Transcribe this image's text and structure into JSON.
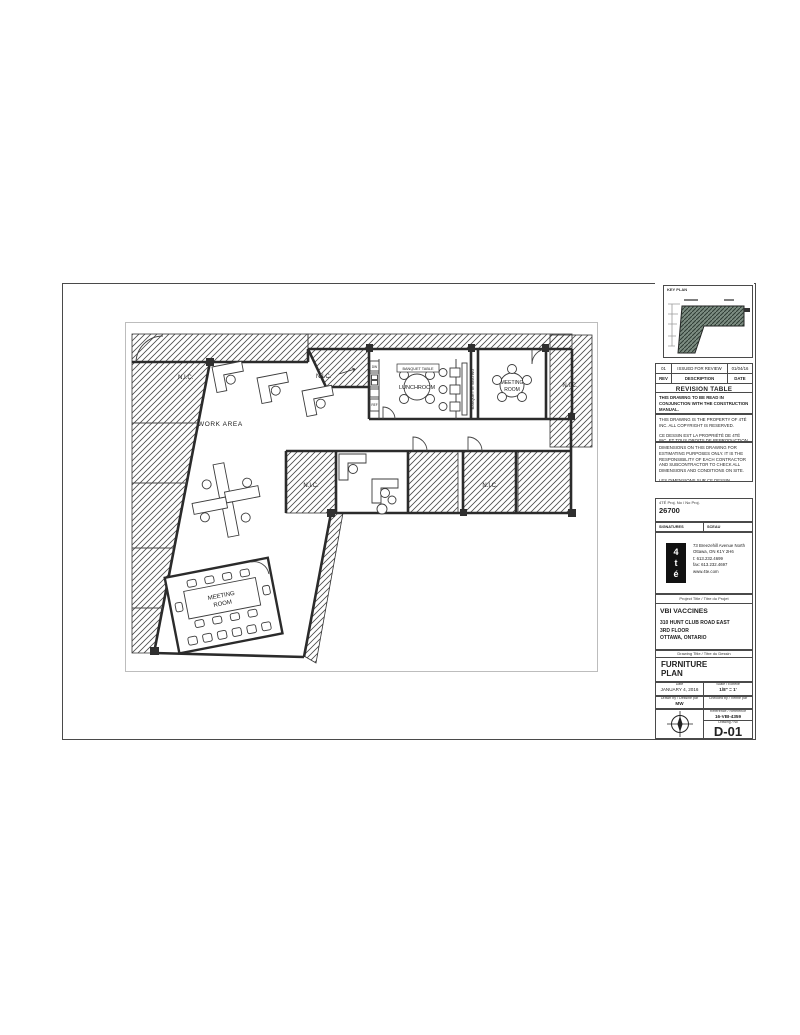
{
  "sheet": {
    "plan": {
      "labels": {
        "work_area": "WORK AREA",
        "lunchroom": "LUNCHROOM",
        "meeting_line1": "MEETING",
        "meeting_line2": "ROOM",
        "nic": "N.I.C.",
        "banquet_table": "BANQUET TABLE",
        "banquette_seating": "BANQUETTE SEATING",
        "dw": "DW",
        "ref": "REF"
      }
    },
    "titleblock": {
      "keyplan_label": "KEY PLAN",
      "revision_table": {
        "title": "REVISION TABLE",
        "header": [
          "REV",
          "DESCRIPTION",
          "DATE"
        ],
        "rows": [
          [
            "01",
            "ISSUED FOR REVIEW",
            "01/04/16"
          ]
        ]
      },
      "notes": [
        "THIS DRAWING TO BE READ IN CONJUNCTION WITH THE CONSTRUCTION MANUAL.",
        "THIS DRAWING IS THE PROPERTY OF 4TÉ INC. ALL COPYRIGHT IS RESERVED.",
        "CE DESSIN EST LA PROPRIÉTÉ DE 4TÉ INC. ET TOUS DROITS DE REPRODUCTION SONT RÉSERVÉS.",
        "DIMENSIONS ON THIS DRAWING FOR ESTIMATING PURPOSES ONLY. IT IS THE RESPONSIBILITY OF EACH CONTRACTOR AND SUBCONTRACTOR TO CHECK ALL DIMENSIONS AND CONDITIONS ON SITE.",
        "LES DIMENSIONS SUR CE DESSIN SERVENT UNIQUEMENT POUR ÉTABLIR UN DEVIS. LES ENTREPRENEURS DEVRONT PRENDRE LEURS PROPRES MESURES SUR LES LIEUX ET EN ÊTRE RESPONSABLES."
      ],
      "project_no_label": "4TÉ Proj. No / No Proj.",
      "project_no": "26700",
      "signatures_label": "SIGNATURES",
      "seal_label": "SCEAU",
      "firm": {
        "logo_text": "4té",
        "address_line1": "73 Breezehill Avenue North",
        "address_line2": "Ottawa, ON K1Y 2H6",
        "phone": "t: 613.232.4699",
        "fax": "fax: 613.232.4697",
        "web": "www.4te.com"
      },
      "project_title_label": "Project Title / Titre du Projet",
      "project_name": "VBI VACCINES",
      "project_address": [
        "310 HUNT CLUB ROAD EAST",
        "3RD FLOOR",
        "OTTAWA, ONTARIO"
      ],
      "drawing_title_label": "Drawing Title / Titre du Dessin",
      "drawing_title_line1": "FURNITURE",
      "drawing_title_line2": "PLAN",
      "date_label": "Date",
      "date": "JANUARY 4, 2016",
      "scale_label": "Scale / Échelle",
      "scale": "1/8\" = 1'",
      "drawn_label": "Drawn by / Dessiné par",
      "drawn_by": "MW",
      "checked_label": "Checked by / Vérifié par",
      "checked_by": "",
      "reference_label": "Reference / Référence",
      "reference": "16-VBI-4359",
      "drawing_no_label": "Drawing / No",
      "drawing_no": "D-01"
    }
  }
}
